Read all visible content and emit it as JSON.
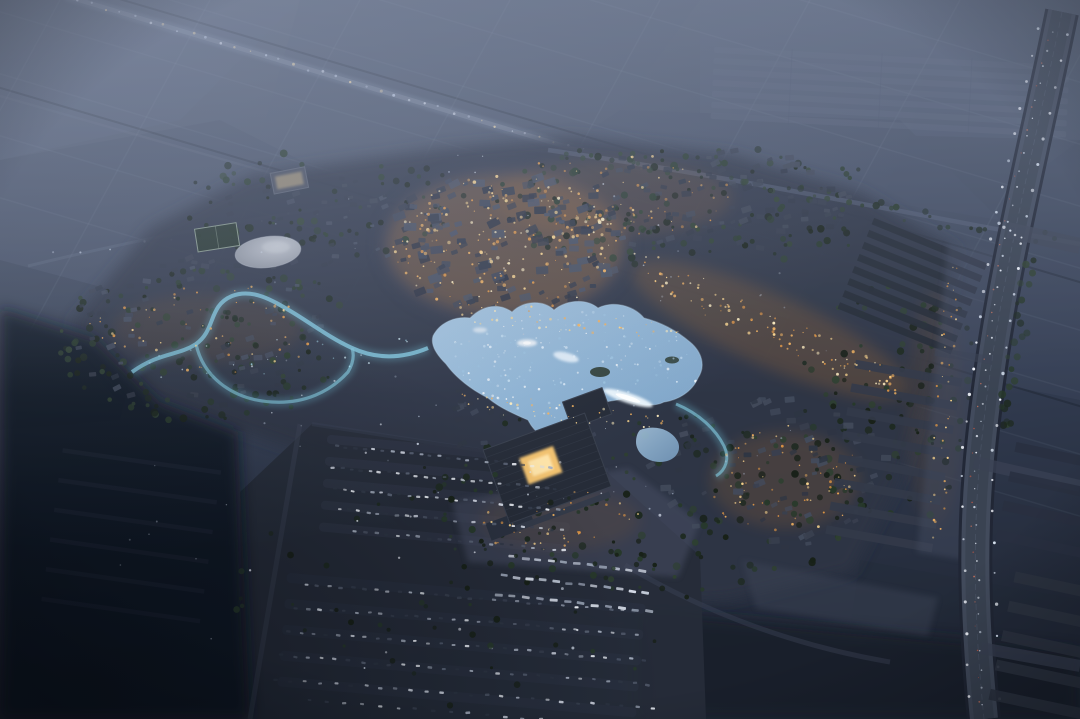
{
  "meta": {
    "description": "Night aerial rendering of a planned lakeside town surrounded by dark farmland",
    "width": 1080,
    "height": 719
  },
  "palette": {
    "town_base": "#2e3545",
    "parking": "#262c39",
    "road_ave": "#454d5f",
    "stream": "#7fc4da",
    "lake_edge": "#bad6ea",
    "courtyard": "#f2c270",
    "dark_corner": "#0d1220",
    "warm_light": "#f2b35c",
    "haze": "#8c98b2"
  },
  "scene": {
    "landmarks": [
      "elevated-highway",
      "main-avenue",
      "old-town-core",
      "central-lake",
      "fountains",
      "winding-stream",
      "round-pond",
      "sports-court",
      "grand-hall",
      "plaza",
      "parking-lot",
      "bus-parking",
      "east-residential-rows",
      "greenhouse-rows",
      "dark-farmland"
    ],
    "generators": [
      {
        "id": "hw-lights",
        "type": "linedots",
        "seed": 11,
        "line": [
          70,
          -2,
          648,
          170
        ],
        "count": 40,
        "jitter": 2,
        "kind": "dot",
        "size": [
          0.7,
          1.5
        ],
        "colors": [
          "#e6ecf8",
          "#c9d4e8",
          "#f7dfae"
        ],
        "op": [
          0.45,
          0.95
        ]
      },
      {
        "id": "nw-lamps",
        "type": "linedots",
        "seed": 12,
        "line": [
          40,
          258,
          424,
          196
        ],
        "count": 13,
        "jitter": 4,
        "kind": "dot",
        "size": [
          0.7,
          1.3
        ],
        "colors": [
          "#e9effb",
          "#cfd9ea"
        ],
        "op": [
          0.35,
          0.8
        ]
      },
      {
        "id": "trees-north",
        "type": "scatter",
        "seed": 21,
        "region": [
          690,
          205,
          210,
          62
        ],
        "count": 150,
        "kind": "dot",
        "size": [
          1.5,
          4
        ],
        "colors": [
          "#1e2a21",
          "#27392a",
          "#182118",
          "#2e4030"
        ],
        "op": [
          0.65,
          1
        ]
      },
      {
        "id": "trees-nw",
        "type": "scatter",
        "seed": 27,
        "region": [
          320,
          205,
          150,
          55
        ],
        "count": 80,
        "kind": "dot",
        "size": [
          1.5,
          4
        ],
        "colors": [
          "#1e2a21",
          "#27392a",
          "#182118",
          "#2e4030"
        ],
        "op": [
          0.65,
          1
        ]
      },
      {
        "id": "trees-west",
        "type": "scatter",
        "seed": 22,
        "region": [
          205,
          338,
          150,
          85
        ],
        "count": 150,
        "kind": "dot",
        "size": [
          1.5,
          4
        ],
        "colors": [
          "#1e2a21",
          "#27392a",
          "#182118",
          "#2e4030"
        ],
        "op": [
          0.65,
          1
        ]
      },
      {
        "id": "trees-south",
        "type": "scatter",
        "seed": 23,
        "region": [
          640,
          500,
          230,
          95
        ],
        "count": 160,
        "kind": "dot",
        "size": [
          1.5,
          4
        ],
        "colors": [
          "#1e2a21",
          "#27392a",
          "#182118",
          "#2e4030"
        ],
        "op": [
          0.65,
          1
        ]
      },
      {
        "id": "trees-east",
        "type": "scatter",
        "seed": 24,
        "region": [
          900,
          400,
          110,
          120
        ],
        "count": 110,
        "kind": "dot",
        "size": [
          1.5,
          4
        ],
        "colors": [
          "#1e2a21",
          "#27392a",
          "#182118",
          "#2e4030"
        ],
        "op": [
          0.65,
          1
        ]
      },
      {
        "id": "trees-ne-road",
        "type": "linedots",
        "seed": 25,
        "line": [
          555,
          152,
          1060,
          242
        ],
        "count": 45,
        "jitter": 7,
        "kind": "dot",
        "size": [
          1.5,
          3.5
        ],
        "colors": [
          "#1e2a21",
          "#27392a",
          "#2e4030"
        ],
        "op": [
          0.55,
          0.95
        ]
      },
      {
        "id": "bld-old",
        "type": "scatter",
        "seed": 31,
        "region": [
          505,
          242,
          118,
          72
        ],
        "count": 130,
        "kind": "rect",
        "size": [
          5,
          13
        ],
        "aspect": 0.62,
        "rot": -12,
        "rotJit": 16,
        "colors": [
          "#3d4556",
          "#485062",
          "#323948",
          "#2b3140"
        ],
        "op": [
          0.7,
          1
        ]
      },
      {
        "id": "bld-north",
        "type": "scatter",
        "seed": 32,
        "region": [
          710,
          200,
          150,
          52
        ],
        "count": 90,
        "kind": "rect",
        "size": [
          5,
          10
        ],
        "aspect": 0.6,
        "rot": -8,
        "rotJit": 20,
        "colors": [
          "#343b4a",
          "#2c3341",
          "#3e4554"
        ],
        "op": [
          0.65,
          0.95
        ]
      },
      {
        "id": "bld-nw",
        "type": "scatter",
        "seed": 36,
        "region": [
          330,
          220,
          120,
          45
        ],
        "count": 45,
        "kind": "rect",
        "size": [
          4,
          8
        ],
        "aspect": 0.6,
        "rot": -10,
        "rotJit": 18,
        "colors": [
          "#39404f",
          "#2e3543",
          "#434b5c"
        ],
        "op": [
          0.65,
          0.95
        ]
      },
      {
        "id": "bld-west",
        "type": "scatter",
        "seed": 33,
        "region": [
          205,
          335,
          140,
          78
        ],
        "count": 70,
        "kind": "rect",
        "size": [
          4.5,
          9
        ],
        "aspect": 0.6,
        "rot": -10,
        "rotJit": 18,
        "colors": [
          "#39404f",
          "#2e3543",
          "#434b5c"
        ],
        "op": [
          0.65,
          0.95
        ]
      },
      {
        "id": "bld-se",
        "type": "scatter",
        "seed": 34,
        "region": [
          770,
          470,
          120,
          80
        ],
        "count": 80,
        "kind": "rect",
        "size": [
          5,
          11
        ],
        "aspect": 0.6,
        "rot": -14,
        "rotJit": 18,
        "colors": [
          "#39404f",
          "#2e3543",
          "#434b5c"
        ],
        "op": [
          0.65,
          0.95
        ]
      },
      {
        "id": "bld-lake-s",
        "type": "scatter",
        "seed": 35,
        "region": [
          520,
          420,
          90,
          40
        ],
        "count": 28,
        "kind": "rect",
        "size": [
          5,
          9
        ],
        "aspect": 0.6,
        "rot": -16,
        "rotJit": 14,
        "colors": [
          "#3d4556",
          "#2f3644"
        ],
        "op": [
          0.7,
          1
        ]
      },
      {
        "id": "lake-sparkle",
        "type": "scatter",
        "seed": 41,
        "region": [
          565,
          372,
          140,
          62
        ],
        "count": 200,
        "kind": "dot",
        "size": [
          0.5,
          1.4
        ],
        "colors": [
          "#ffffff",
          "#e4f1fb",
          "#c2dcef",
          "#9cc3e0"
        ],
        "op": [
          0.3,
          0.95
        ]
      },
      {
        "id": "stream-glint",
        "type": "linedots",
        "seed": 42,
        "line": [
          140,
          365,
          430,
          350
        ],
        "count": 24,
        "jitter": 18,
        "kind": "dot",
        "size": [
          0.5,
          1.1
        ],
        "colors": [
          "#d8f3fc",
          "#a9e2f2"
        ],
        "op": [
          0.4,
          0.9
        ]
      },
      {
        "id": "warm-old",
        "type": "scatter",
        "seed": 51,
        "region": [
          505,
          244,
          112,
          70
        ],
        "count": 190,
        "kind": "dot",
        "size": [
          0.5,
          1.8
        ],
        "colors": [
          "#ffd98f",
          "#f4b35f",
          "#e79a44",
          "#ffeebf"
        ],
        "op": [
          0.55,
          1
        ]
      },
      {
        "id": "warm-estreet",
        "type": "linedots",
        "seed": 52,
        "line": [
          642,
          268,
          902,
          386
        ],
        "count": 110,
        "jitter": 15,
        "kind": "dot",
        "size": [
          0.5,
          1.6
        ],
        "colors": [
          "#ffd98f",
          "#f4b35f",
          "#e79a44",
          "#ffeebf"
        ],
        "op": [
          0.5,
          1
        ]
      },
      {
        "id": "warm-north",
        "type": "scatter",
        "seed": 53,
        "region": [
          612,
          196,
          125,
          42
        ],
        "count": 65,
        "kind": "dot",
        "size": [
          0.5,
          1.5
        ],
        "colors": [
          "#ffd98f",
          "#f4b35f",
          "#e79a44"
        ],
        "op": [
          0.45,
          0.95
        ]
      },
      {
        "id": "warm-west",
        "type": "scatter",
        "seed": 54,
        "region": [
          205,
          328,
          118,
          48
        ],
        "count": 55,
        "kind": "dot",
        "size": [
          0.5,
          1.5
        ],
        "colors": [
          "#ffd98f",
          "#f4b35f",
          "#e79a44"
        ],
        "op": [
          0.45,
          0.95
        ]
      },
      {
        "id": "warm-se",
        "type": "scatter",
        "seed": 55,
        "region": [
          785,
          480,
          80,
          55
        ],
        "count": 65,
        "kind": "dot",
        "size": [
          0.5,
          1.5
        ],
        "colors": [
          "#ffd98f",
          "#f4b35f",
          "#e79a44"
        ],
        "op": [
          0.45,
          0.95
        ]
      },
      {
        "id": "warm-shore-n",
        "type": "linedots",
        "seed": 56,
        "line": [
          465,
          315,
          680,
          332
        ],
        "count": 38,
        "jitter": 8,
        "kind": "dot",
        "size": [
          0.5,
          1.4
        ],
        "colors": [
          "#ffd98f",
          "#f4b35f",
          "#ffeebf"
        ],
        "op": [
          0.5,
          1
        ]
      },
      {
        "id": "warm-shore-s",
        "type": "linedots",
        "seed": 57,
        "line": [
          455,
          400,
          668,
          424
        ],
        "count": 42,
        "jitter": 10,
        "kind": "dot",
        "size": [
          0.5,
          1.4
        ],
        "colors": [
          "#ffd98f",
          "#f4b35f",
          "#ffeebf"
        ],
        "op": [
          0.5,
          1
        ]
      },
      {
        "id": "warm-hall",
        "type": "scatter",
        "seed": 58,
        "region": [
          560,
          522,
          85,
          35
        ],
        "count": 38,
        "kind": "dot",
        "size": [
          0.5,
          1.4
        ],
        "colors": [
          "#ffd98f",
          "#f4b35f",
          "#e79a44"
        ],
        "op": [
          0.45,
          0.95
        ]
      },
      {
        "id": "warm-band",
        "type": "linedots",
        "seed": 59,
        "line": [
          955,
          262,
          935,
          540
        ],
        "count": 40,
        "jitter": 9,
        "kind": "dot",
        "size": [
          0.5,
          1.4
        ],
        "colors": [
          "#ffd98f",
          "#f4b35f",
          "#e79a44"
        ],
        "op": [
          0.45,
          0.95
        ]
      },
      {
        "id": "cool-town",
        "type": "scatter",
        "seed": 61,
        "region": [
          540,
          330,
          330,
          190
        ],
        "count": 70,
        "kind": "dot",
        "size": [
          0.5,
          1.1
        ],
        "colors": [
          "#dfe8f4",
          "#b9c6da"
        ],
        "op": [
          0.25,
          0.75
        ]
      },
      {
        "id": "cars",
        "type": "rows",
        "seed": 71,
        "rows": [
          [
            332,
            446,
            556,
            468,
            24
          ],
          [
            328,
            467,
            560,
            489,
            25
          ],
          [
            330,
            488,
            562,
            510,
            25
          ],
          [
            334,
            509,
            566,
            531,
            24
          ],
          [
            350,
            531,
            570,
            551,
            21
          ],
          [
            300,
            584,
            640,
            612,
            29
          ],
          [
            290,
            607,
            642,
            635,
            29
          ],
          [
            282,
            631,
            650,
            661,
            29
          ],
          [
            274,
            655,
            655,
            685,
            28
          ],
          [
            268,
            679,
            660,
            709,
            26
          ],
          [
            300,
            700,
            620,
            726,
            18
          ]
        ],
        "jitter": 2.2,
        "kind": "rect",
        "size": [
          3.6,
          4.8
        ],
        "aspect": 0.52,
        "rotJit": 8,
        "colors": [
          "#d4dae6",
          "#a7b0c0",
          "#5b6476",
          "#3a4252",
          "#eef2f8",
          "#2e3644"
        ],
        "op": [
          0.55,
          1
        ]
      },
      {
        "id": "buses",
        "type": "rows",
        "seed": 72,
        "rows": [
          [
            506,
            556,
            648,
            572,
            11
          ],
          [
            498,
            575,
            652,
            593,
            12
          ],
          [
            492,
            594,
            656,
            612,
            12
          ]
        ],
        "jitter": 1.5,
        "kind": "rect",
        "size": [
          6.8,
          8.2
        ],
        "aspect": 0.36,
        "rotJit": 4,
        "colors": [
          "#dde3ee",
          "#c2cad8",
          "#98a2b4"
        ],
        "op": [
          0.65,
          1
        ]
      },
      {
        "id": "park-trees",
        "type": "scatter",
        "seed": 73,
        "region": [
          470,
          590,
          240,
          120
        ],
        "count": 55,
        "kind": "dot",
        "size": [
          1.5,
          3.5
        ],
        "colors": [
          "#1e2a21",
          "#27392a",
          "#182118"
        ],
        "op": [
          0.7,
          1
        ]
      },
      {
        "id": "park-lamps",
        "type": "scatter",
        "seed": 74,
        "region": [
          460,
          560,
          220,
          130
        ],
        "count": 15,
        "kind": "dot",
        "size": [
          0.9,
          1.5
        ],
        "colors": [
          "#f2f6ff",
          "#dfe8f6"
        ],
        "op": [
          0.4,
          0.9
        ]
      },
      {
        "id": "trees-ave",
        "type": "linedots",
        "seed": 26,
        "line": [
          1034,
          252,
          1002,
          430
        ],
        "count": 22,
        "jitter": 9,
        "kind": "dot",
        "size": [
          2,
          4
        ],
        "colors": [
          "#1e2a21",
          "#27392a",
          "#2e4030"
        ],
        "op": [
          0.5,
          0.9
        ]
      },
      {
        "id": "ave-cars-w",
        "type": "rows",
        "seed": 81,
        "rows": [
          [
            1054,
            24,
            1006,
            230,
            12
          ],
          [
            1006,
            230,
            974,
            462,
            14
          ],
          [
            974,
            462,
            983,
            714,
            14
          ]
        ],
        "jitter": 2.5,
        "kind": "dot",
        "size": [
          0.6,
          1.2
        ],
        "colors": [
          "#e8eef8",
          "#cdd7e6"
        ],
        "op": [
          0.55,
          1
        ]
      },
      {
        "id": "ave-cars-r",
        "type": "rows",
        "seed": 82,
        "rows": [
          [
            1050,
            28,
            1002,
            232,
            9
          ],
          [
            1002,
            232,
            970,
            464,
            10
          ],
          [
            970,
            464,
            979,
            714,
            10
          ]
        ],
        "jitter": 2.5,
        "kind": "dot",
        "size": [
          0.5,
          1
        ],
        "colors": [
          "#e07a5f",
          "#c05846"
        ],
        "op": [
          0.45,
          0.9
        ]
      },
      {
        "id": "ave-lamps",
        "type": "rows",
        "seed": 83,
        "rows": [
          [
            1070,
            22,
            1023,
            230,
            8
          ],
          [
            1023,
            230,
            991,
            464,
            9
          ],
          [
            991,
            464,
            1000,
            714,
            8
          ],
          [
            1041,
            16,
            993,
            226,
            8
          ],
          [
            993,
            226,
            961,
            460,
            9
          ],
          [
            961,
            460,
            969,
            712,
            8
          ],
          [
            996,
            222,
            1024,
            240,
            5
          ]
        ],
        "jitter": 1.5,
        "kind": "dot",
        "size": [
          1,
          1.7
        ],
        "colors": [
          "#f6f9ff",
          "#dce6f4"
        ],
        "op": [
          0.6,
          1
        ]
      },
      {
        "id": "dark-lamps",
        "type": "scatter",
        "seed": 91,
        "region": [
          140,
          560,
          120,
          140
        ],
        "count": 8,
        "kind": "dot",
        "size": [
          0.6,
          1
        ],
        "colors": [
          "#cdd6e6"
        ],
        "op": [
          0.25,
          0.55
        ]
      }
    ]
  }
}
